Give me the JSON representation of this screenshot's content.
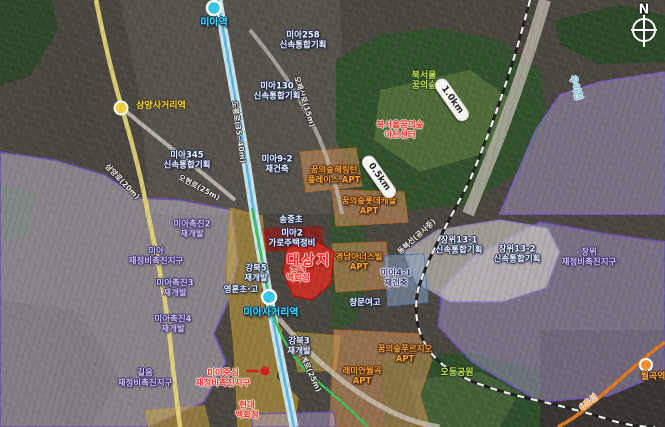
{
  "map": {
    "description": "satellite-redevelopment-map",
    "colors": {
      "target_red": "#e02a20",
      "zone_purple_border": "#6c50b0",
      "zone_lavender_fill": "#cdc6dc",
      "zone_yellow_fill": "#cda83c",
      "zone_tan_fill": "#d2915a",
      "zone_gray_fill": "#e3e0d9",
      "zone_blue_fill": "#8ca5cd",
      "line_cyan": "#57b8e8",
      "line_green": "#3dbf58",
      "line6_orange": "#e07820",
      "road_yellow": "#e8d878"
    },
    "compass": {
      "label": "N"
    },
    "labels": [
      {
        "id": "station-mia",
        "lines": [
          "미아역"
        ],
        "type": "station-cyan",
        "x": 214,
        "y": 23,
        "rot": 0
      },
      {
        "id": "station-samyang-sageori",
        "lines": [
          "삼양사거리역"
        ],
        "type": "station-yellow",
        "x": 161,
        "y": 106,
        "rot": 0
      },
      {
        "id": "station-mia-sageori",
        "lines": [
          "미아사거리역"
        ],
        "type": "station-cyan",
        "x": 271,
        "y": 313,
        "rot": 0
      },
      {
        "id": "station-wolgok",
        "lines": [
          "월곡역"
        ],
        "type": "station-orange",
        "x": 653,
        "y": 377,
        "rot": 0
      },
      {
        "id": "line6-label",
        "lines": [
          "6호선"
        ],
        "type": "line-orange",
        "x": 589,
        "y": 403,
        "rot": -38
      },
      {
        "id": "road-dobongro",
        "lines": [
          "도봉로(35~40m)"
        ],
        "type": "road",
        "x": 238,
        "y": 132,
        "rot": 82
      },
      {
        "id": "road-opaesanro",
        "lines": [
          "오패산로(15m)"
        ],
        "type": "road",
        "x": 304,
        "y": 102,
        "rot": 72
      },
      {
        "id": "road-ohyeonro",
        "lines": [
          "오현로(25m)"
        ],
        "type": "road",
        "x": 199,
        "y": 188,
        "rot": 28
      },
      {
        "id": "road-samyangro",
        "lines": [
          "삼양로(20m)"
        ],
        "type": "road",
        "x": 122,
        "y": 182,
        "rot": 46
      },
      {
        "id": "road-wolgyero",
        "lines": [
          "월계로(25m)"
        ],
        "type": "road",
        "x": 309,
        "y": 371,
        "rot": 65
      },
      {
        "id": "stream-uicheon",
        "lines": [
          "우이천"
        ],
        "type": "stream",
        "x": 575,
        "y": 88,
        "rot": 74
      },
      {
        "id": "line-northeast-constr",
        "lines": [
          "동북선(공사중)"
        ],
        "type": "road",
        "x": 417,
        "y": 237,
        "rot": -42
      },
      {
        "id": "zone-mia258",
        "lines": [
          "미아258",
          "신속통합기획"
        ],
        "type": "zone-white",
        "x": 303,
        "y": 41,
        "rot": 0
      },
      {
        "id": "zone-mia130",
        "lines": [
          "미아130",
          "신속통합기획"
        ],
        "type": "zone-white",
        "x": 277,
        "y": 92,
        "rot": 0
      },
      {
        "id": "zone-mia345",
        "lines": [
          "미아345",
          "신속통합기획"
        ],
        "type": "zone-white",
        "x": 187,
        "y": 161,
        "rot": 0
      },
      {
        "id": "zone-mia9-2",
        "lines": [
          "미아9-2",
          "재건축"
        ],
        "type": "zone-white",
        "x": 277,
        "y": 165,
        "rot": 0
      },
      {
        "id": "zone-jangwi13-1",
        "lines": [
          "장위13-1",
          "신속통합기획"
        ],
        "type": "zone-white",
        "x": 459,
        "y": 246,
        "rot": 0
      },
      {
        "id": "zone-jangwi13-2",
        "lines": [
          "장위13-2",
          "신속통합기획"
        ],
        "type": "zone-white",
        "x": 517,
        "y": 255,
        "rot": 0
      },
      {
        "id": "zone-mia-chokjin2",
        "lines": [
          "미아촉진2",
          "재개발"
        ],
        "type": "zone-purple",
        "x": 192,
        "y": 230,
        "rot": 0
      },
      {
        "id": "zone-mia-district",
        "lines": [
          "미아",
          "재정비촉진지구"
        ],
        "type": "zone-purple",
        "x": 156,
        "y": 257,
        "rot": 0
      },
      {
        "id": "zone-mia-chokjin3",
        "lines": [
          "미아촉진3",
          "재개발"
        ],
        "type": "zone-purple",
        "x": 175,
        "y": 289,
        "rot": 0
      },
      {
        "id": "zone-mia-chokjin4",
        "lines": [
          "미아촉진4",
          "재개발"
        ],
        "type": "zone-purple",
        "x": 173,
        "y": 325,
        "rot": 0
      },
      {
        "id": "zone-gireum-district",
        "lines": [
          "길음",
          "재정비촉진지구"
        ],
        "type": "zone-purple",
        "x": 145,
        "y": 379,
        "rot": 0
      },
      {
        "id": "zone-jangwi-district",
        "lines": [
          "장위",
          "재정비촉진지구"
        ],
        "type": "zone-purple",
        "x": 589,
        "y": 258,
        "rot": 0
      },
      {
        "id": "zone-mia4-1",
        "lines": [
          "미아4-1",
          "재건축"
        ],
        "type": "zone-dark",
        "x": 396,
        "y": 279,
        "rot": 0
      },
      {
        "id": "zone-gangbuk3",
        "lines": [
          "강북3",
          "재개발"
        ],
        "type": "zone-white",
        "x": 299,
        "y": 347,
        "rot": 0
      },
      {
        "id": "zone-gangbuk5",
        "lines": [
          "강북5",
          "재개발"
        ],
        "type": "zone-white",
        "x": 256,
        "y": 274,
        "rot": 0
      },
      {
        "id": "poi-lotte-dept",
        "lines": [
          "롯데",
          "백화점"
        ],
        "type": "label-red",
        "x": 298,
        "y": 274,
        "rot": 0
      },
      {
        "id": "poi-younghoon-school",
        "lines": [
          "영훈초·고"
        ],
        "type": "zone-white",
        "x": 241,
        "y": 291,
        "rot": 0
      },
      {
        "id": "poi-songjung-elem",
        "lines": [
          "송중초"
        ],
        "type": "zone-white",
        "x": 291,
        "y": 221,
        "rot": 0
      },
      {
        "id": "poi-changmun-girls-hs",
        "lines": [
          "창문여고"
        ],
        "type": "zone-white",
        "x": 365,
        "y": 304,
        "rot": 0
      },
      {
        "id": "zone-mia2-garo",
        "lines": [
          "미아2",
          "가로주택정비"
        ],
        "type": "zone-white",
        "x": 292,
        "y": 239,
        "rot": 0
      },
      {
        "id": "target-site",
        "lines": [
          "대상지"
        ],
        "type": "target",
        "x": 309,
        "y": 262,
        "rot": 0
      },
      {
        "id": "zone-mia-center",
        "lines": [
          "미아중심",
          "재정비촉진지구"
        ],
        "type": "label-red",
        "x": 223,
        "y": 379,
        "rot": 0
      },
      {
        "id": "poi-hyundai-dept",
        "lines": [
          "현대",
          "백화점"
        ],
        "type": "label-red",
        "x": 247,
        "y": 411,
        "rot": 0
      },
      {
        "id": "apt-harrington",
        "lines": [
          "꿈의숲해링턴",
          "플레이스 APT"
        ],
        "type": "label-orange",
        "x": 334,
        "y": 176,
        "rot": 0
      },
      {
        "id": "apt-lotte-castle",
        "lines": [
          "꿈의숲롯데캐슬",
          "APT"
        ],
        "type": "label-orange",
        "x": 369,
        "y": 207,
        "rot": 0
      },
      {
        "id": "apt-kyungnam",
        "lines": [
          "경남아너스빌",
          "APT"
        ],
        "type": "label-orange",
        "x": 359,
        "y": 263,
        "rot": 0
      },
      {
        "id": "apt-prugio",
        "lines": [
          "꿈의숲푸르지오",
          "APT"
        ],
        "type": "label-orange",
        "x": 405,
        "y": 355,
        "rot": 0
      },
      {
        "id": "apt-raemian-wolgok",
        "lines": [
          "래미안월곡",
          "APT"
        ],
        "type": "label-orange",
        "x": 362,
        "y": 377,
        "rot": 0
      },
      {
        "id": "park-dream-forest",
        "lines": [
          "북서울",
          "꿈의숲"
        ],
        "type": "label-green",
        "x": 424,
        "y": 81,
        "rot": 0
      },
      {
        "id": "poi-art-center",
        "lines": [
          "북서울꿈의숲",
          "아트센터"
        ],
        "type": "label-red",
        "x": 400,
        "y": 131,
        "rot": 0
      },
      {
        "id": "park-odong",
        "lines": [
          "오동공원"
        ],
        "type": "label-green",
        "x": 457,
        "y": 373,
        "rot": 0
      },
      {
        "id": "badge-1-0km",
        "lines": [
          "1.0km"
        ],
        "type": "pill",
        "x": 452,
        "y": 100,
        "rot": 55
      },
      {
        "id": "badge-0-5km",
        "lines": [
          "0.5km"
        ],
        "type": "pill",
        "x": 379,
        "y": 177,
        "rot": 55
      },
      {
        "id": "compass-n-label",
        "lines": [
          "N"
        ],
        "type": "compass-n",
        "x": 644,
        "y": 11,
        "rot": 0
      }
    ]
  }
}
